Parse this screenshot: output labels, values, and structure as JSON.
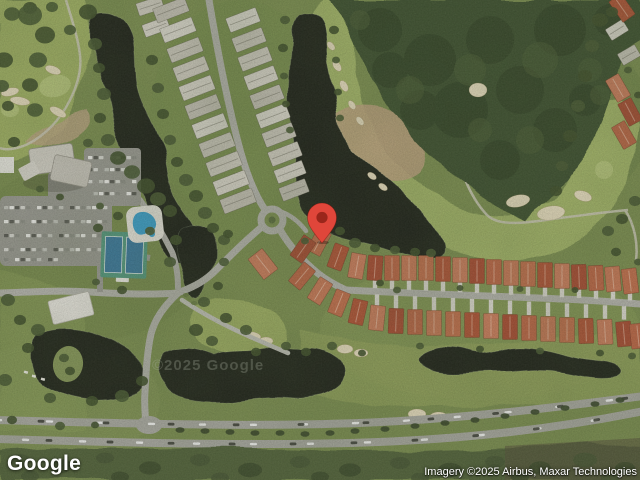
{
  "map": {
    "logo": "Google",
    "attribution": "Imagery ©2025 Airbus, Maxar Technologies",
    "watermark": "©2025 Google",
    "pin": {
      "icon": "red-map-pin-icon",
      "color": "#E0463A",
      "inner_color": "#9A261B"
    },
    "colors": {
      "water": "#21261b",
      "forest": "#405231",
      "fairway": "#a5b76b",
      "road": "#b5b5ad",
      "terracotta_roof": "#b85f41",
      "gray_roof": "#cecbbe"
    }
  }
}
